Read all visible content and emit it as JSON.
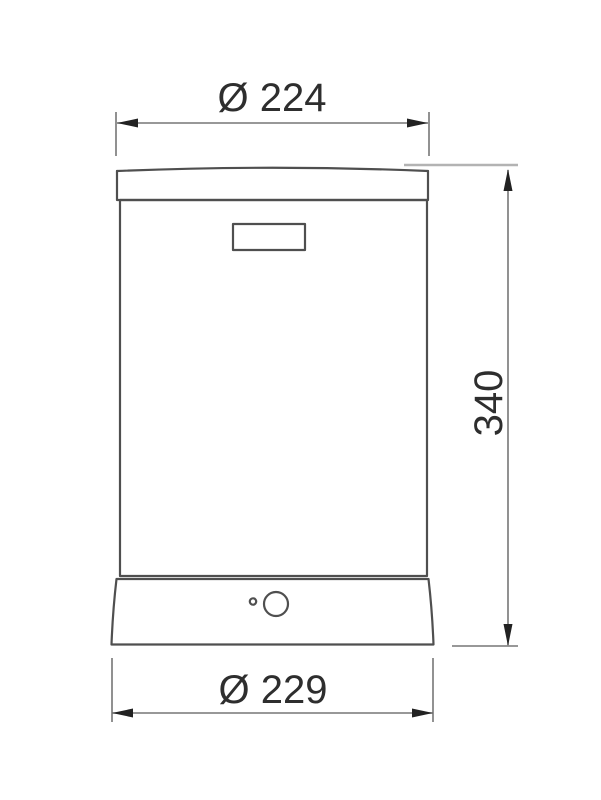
{
  "drawing": {
    "kind": "technical-dimension-drawing",
    "dimensions": {
      "top_diameter_label": "Ø 224",
      "height_label": "340",
      "bottom_diameter_label": "Ø 229"
    },
    "dimension_values": {
      "top_diameter": 224,
      "height": 340,
      "bottom_diameter": 229
    },
    "colors": {
      "background": "#ffffff",
      "object_stroke": "#4f4f4f",
      "dimension_stroke": "#767676",
      "light_extension_stroke": "#b3b3b3",
      "arrow_fill": "#222222",
      "text": "#2e2e2e"
    }
  }
}
